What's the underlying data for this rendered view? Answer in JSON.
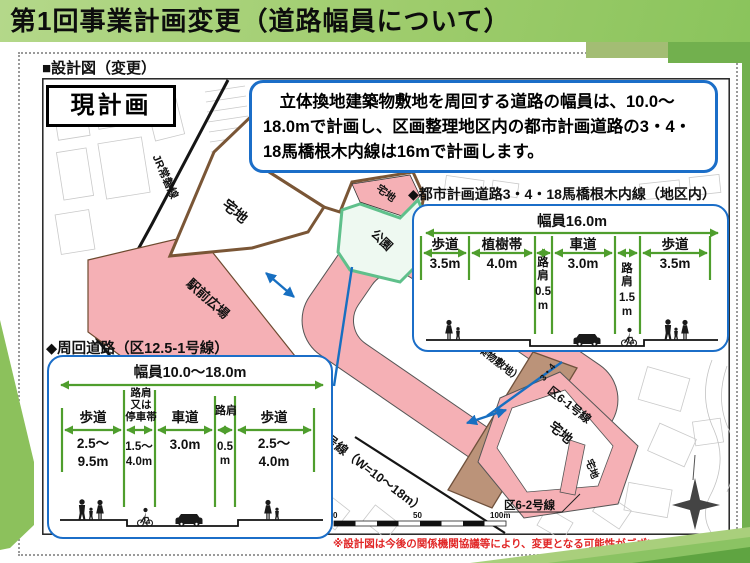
{
  "slide": {
    "title": "第1回事業計画変更（道路幅員について）",
    "section_label": "■設計図（変更）",
    "plan_label": "現計画",
    "note": "※設計図は今後の関係機関協議等により、変更となる可能性がございます。"
  },
  "callout": {
    "line1": "　立体換地建築物敷地を周回する道路の幅員は、10.0～",
    "line2": "18.0mで計画し、区画整理地区内の都市計画道路の3・4・",
    "line3": "18馬橋根木内線は16mで計画します。"
  },
  "map": {
    "railway": "JR常磐線",
    "takuchi_nw": "宅地",
    "takuchi_top": "宅地",
    "park": "公園",
    "plaza": "駅前広場",
    "takuchi_center_main": "宅地",
    "takuchi_center_sub": "（立体換地建築物敷地）",
    "takuchi_east": "宅地",
    "takuchi_east_small": "宅地",
    "route61": "区6-1号線",
    "route62": "区6-2号線",
    "route_w": "号線（W=10～18m）",
    "route34": "3・4",
    "scale0": "0",
    "scale50": "50",
    "scale100": "100m"
  },
  "xsecA": {
    "heading": "◆都市計画道路3・4・18馬橋根木内線（地区内）",
    "width": "幅員16.0m",
    "names": [
      "歩道",
      "植樹帯",
      "車道",
      "歩道"
    ],
    "values": [
      "3.5m",
      "4.0m",
      "3.0m",
      "3.5m"
    ],
    "shoulder1": [
      "路",
      "肩",
      "0.5",
      "m"
    ],
    "shoulder2": [
      "路",
      "肩",
      "1.5",
      "m"
    ]
  },
  "xsecB": {
    "heading": "◆周回道路（区12.5-1号線）",
    "width": "幅員10.0～18.0m",
    "walk1": "歩道",
    "walk1v": [
      "2.5～",
      "9.5m"
    ],
    "stop_label": [
      "路肩",
      "又は",
      "停車帯"
    ],
    "stopv": [
      "1.5～",
      "4.0m"
    ],
    "road": "車道",
    "roadv": "3.0m",
    "sh_label": "路肩",
    "shv": [
      "0.5",
      "m"
    ],
    "walk2": "歩道",
    "walk2v": [
      "2.5～",
      "4.0m"
    ]
  },
  "colors": {
    "accent_blue": "#1b6ec8",
    "guide_green": "#4f9e2d",
    "zone_pink": "#f5b0b5",
    "road_brown": "#bb9379",
    "park_green": "#5fc08b",
    "note_red": "#e12727",
    "header_green": "#9ecc6c"
  }
}
